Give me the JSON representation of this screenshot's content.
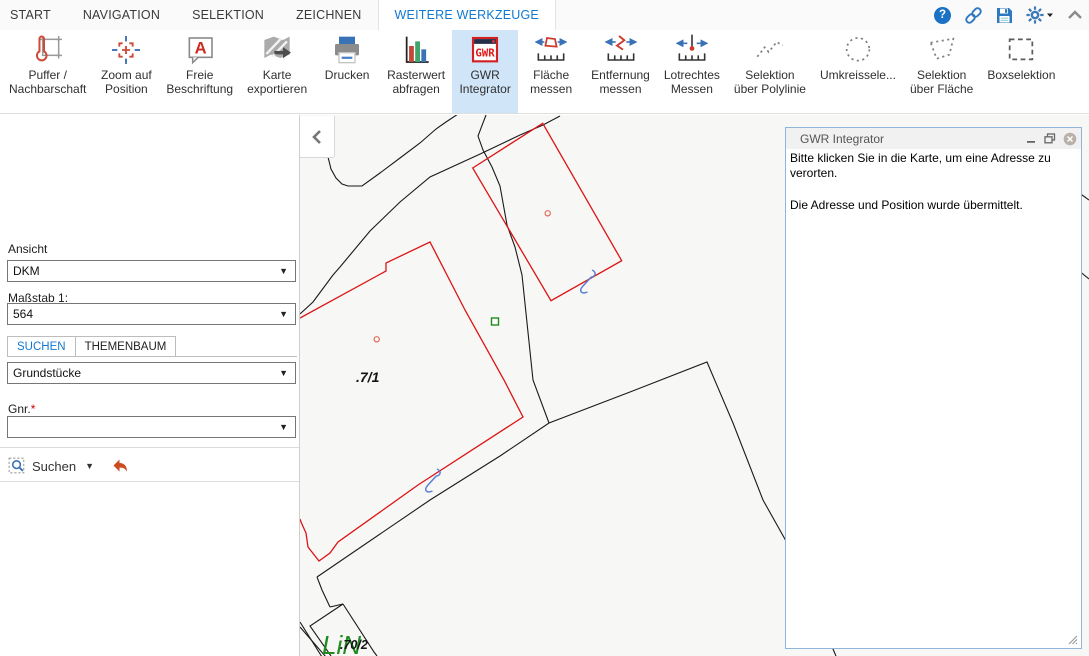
{
  "colors": {
    "accent": "#1179d1",
    "ribbon_selected_bg": "#d0e5f8",
    "map_black": "#1a1a1a",
    "map_red": "#dc1414",
    "map_marker_red": "#e06a5a",
    "map_green": "#1e8c1e",
    "map_blue": "#5b7fd4",
    "panel_border": "#8fb6da"
  },
  "menu": {
    "tabs": [
      {
        "label": "START",
        "active": false
      },
      {
        "label": "NAVIGATION",
        "active": false
      },
      {
        "label": "SELEKTION",
        "active": false
      },
      {
        "label": "ZEICHNEN",
        "active": false
      },
      {
        "label": "WEITERE WERKZEUGE",
        "active": true
      }
    ]
  },
  "titlebar": {
    "icons": [
      "help-icon",
      "link-icon",
      "save-icon",
      "settings-icon",
      "collapse-ribbon-icon"
    ]
  },
  "ribbon": {
    "buttons": [
      {
        "id": "puffer-nachbarschaft",
        "icon": "buffer",
        "label_lines": [
          "Puffer /",
          "Nachbarschaft"
        ],
        "selected": false
      },
      {
        "id": "zoom-auf-position",
        "icon": "zoompos",
        "label_lines": [
          "Zoom auf",
          "Position"
        ],
        "selected": false
      },
      {
        "id": "freie-beschriftung",
        "icon": "freelabel",
        "label_lines": [
          "Freie",
          "Beschriftung"
        ],
        "selected": false
      },
      {
        "id": "karte-exportieren",
        "icon": "exportmap",
        "label_lines": [
          "Karte",
          "exportieren"
        ],
        "selected": false
      },
      {
        "id": "drucken",
        "icon": "print",
        "label_lines": [
          "Drucken"
        ],
        "selected": false
      },
      {
        "id": "rasterwert-abfragen",
        "icon": "raster",
        "label_lines": [
          "Rasterwert",
          "abfragen"
        ],
        "selected": false
      },
      {
        "id": "gwr-integrator",
        "icon": "gwr",
        "label_lines": [
          "GWR",
          "Integrator"
        ],
        "selected": true
      },
      {
        "id": "flaeche-messen",
        "icon": "marea",
        "label_lines": [
          "Fläche",
          "messen"
        ],
        "selected": false
      },
      {
        "id": "entfernung-messen",
        "icon": "mdist",
        "label_lines": [
          "Entfernung",
          "messen"
        ],
        "selected": false
      },
      {
        "id": "lotrechtes-messen",
        "icon": "mperp",
        "label_lines": [
          "Lotrechtes",
          "Messen"
        ],
        "selected": false
      },
      {
        "id": "selektion-polylinie",
        "icon": "selpoly",
        "label_lines": [
          "Selektion",
          "über Polylinie"
        ],
        "selected": false
      },
      {
        "id": "umkreisselektion",
        "icon": "selradius",
        "label_lines": [
          "Umkreissele..."
        ],
        "selected": false
      },
      {
        "id": "selektion-flaeche",
        "icon": "selarea",
        "label_lines": [
          "Selektion",
          "über Fläche"
        ],
        "selected": false
      },
      {
        "id": "boxselektion",
        "icon": "selbox",
        "label_lines": [
          "Boxselektion"
        ],
        "selected": false
      }
    ]
  },
  "sidebar": {
    "ansicht_label": "Ansicht",
    "ansicht_value": "DKM",
    "massstab_label": "Maßstab 1:",
    "massstab_value": "564",
    "tabs": [
      {
        "label": "SUCHEN",
        "active": true
      },
      {
        "label": "THEMENBAUM",
        "active": false
      }
    ],
    "layer_value": "Grundstücke",
    "gnr_label": "Gnr.",
    "required_marker": "*",
    "gnr_value": "",
    "search_button_label": "Suchen"
  },
  "panel": {
    "title": "GWR Integrator",
    "messages": [
      "Bitte klicken Sie in die Karte, um eine Adresse zu verorten.",
      "Die Adresse und Position wurde übermittelt."
    ]
  },
  "map": {
    "background": "#f7f7f6",
    "shapes": [
      {
        "name": "boundary-curve-topleft",
        "color": "black",
        "points": [
          [
            328,
            157
          ],
          [
            331,
            169
          ],
          [
            336,
            178
          ],
          [
            342,
            184
          ],
          [
            348,
            186
          ],
          [
            362,
            186
          ],
          [
            380,
            173
          ],
          [
            400,
            158
          ],
          [
            420,
            143
          ],
          [
            436,
            129
          ],
          [
            446,
            122
          ],
          [
            458,
            114
          ]
        ]
      },
      {
        "name": "road-edge-inner",
        "color": "black",
        "points": [
          [
            486,
            115
          ],
          [
            478,
            136
          ],
          [
            483,
            150
          ],
          [
            492,
            167
          ],
          [
            500,
            186
          ],
          [
            507,
            225
          ],
          [
            515,
            247
          ],
          [
            522,
            275
          ],
          [
            533,
            380
          ],
          [
            549,
            423
          ]
        ]
      },
      {
        "name": "road-edge-outer",
        "color": "black",
        "points": [
          [
            560,
            116
          ],
          [
            543,
            125
          ],
          [
            520,
            135
          ],
          [
            497,
            146
          ],
          [
            478,
            155
          ],
          [
            430,
            177
          ],
          [
            400,
            202
          ],
          [
            370,
            231
          ],
          [
            350,
            255
          ],
          [
            340,
            267
          ],
          [
            333,
            275
          ],
          [
            313,
            302
          ],
          [
            300,
            314
          ]
        ]
      },
      {
        "name": "boundary-bottom-diagonal",
        "color": "black",
        "points": [
          [
            317,
            577
          ],
          [
            430,
            500
          ],
          [
            500,
            456
          ],
          [
            549,
            423
          ],
          [
            630,
            392
          ],
          [
            707,
            362
          ],
          [
            733,
            423
          ],
          [
            763,
            500
          ],
          [
            786,
            541
          ],
          [
            836,
            656
          ]
        ]
      },
      {
        "name": "boundary-corner-drop",
        "color": "black",
        "points": [
          [
            317,
            577
          ],
          [
            322,
            590
          ],
          [
            330,
            607
          ]
        ]
      },
      {
        "name": "small-parcel-left",
        "color": "black",
        "points": [
          [
            330,
            607
          ],
          [
            343,
            604
          ],
          [
            310,
            626
          ],
          [
            331,
            656
          ]
        ]
      },
      {
        "name": "small-parcel-right",
        "color": "black",
        "points": [
          [
            343,
            604
          ],
          [
            374,
            652
          ],
          [
            377,
            656
          ]
        ]
      },
      {
        "name": "double-line-a",
        "color": "black",
        "points": [
          [
            300,
            622
          ],
          [
            322,
            657
          ]
        ]
      },
      {
        "name": "double-line-b",
        "color": "black",
        "points": [
          [
            300,
            627
          ],
          [
            326,
            657
          ]
        ]
      },
      {
        "name": "edge-fragment-right-1",
        "color": "black",
        "points": [
          [
            1078,
            192
          ],
          [
            1089,
            200
          ]
        ]
      },
      {
        "name": "edge-fragment-right-2",
        "color": "black",
        "points": [
          [
            1078,
            270
          ],
          [
            1089,
            279
          ]
        ]
      },
      {
        "name": "building-outline-red",
        "color": "red",
        "closed": true,
        "points": [
          [
            472.7,
            168
          ],
          [
            542.7,
            123.3
          ],
          [
            621.7,
            260.7
          ],
          [
            551,
            300.7
          ]
        ]
      },
      {
        "name": "parcel-outline-red",
        "color": "red",
        "points": [
          [
            300,
            318
          ],
          [
            386,
            271
          ],
          [
            386,
            263
          ],
          [
            430,
            242
          ],
          [
            465,
            310
          ],
          [
            504,
            380
          ],
          [
            523,
            417
          ],
          [
            418,
            485
          ],
          [
            338,
            542
          ],
          [
            330,
            553
          ],
          [
            319,
            561
          ],
          [
            308,
            547
          ],
          [
            306,
            533
          ],
          [
            301,
            522
          ],
          [
            300,
            519
          ]
        ]
      }
    ],
    "markers": [
      {
        "type": "circle",
        "x": 547.7,
        "y": 213.3
      },
      {
        "type": "circle",
        "x": 376.7,
        "y": 339.3
      },
      {
        "type": "square",
        "x": 495,
        "y": 321.5
      },
      {
        "type": "z",
        "x": 586,
        "y": 281
      },
      {
        "type": "z",
        "x": 431,
        "y": 480
      }
    ],
    "labels": [
      {
        "text": "LiN",
        "x": 322,
        "y": 654,
        "style": "green"
      },
      {
        "text": ".7/1",
        "x": 356,
        "y": 382,
        "style": "parcel"
      },
      {
        "text": ".70/2",
        "x": 340,
        "y": 649,
        "style": "parcel-small"
      }
    ]
  }
}
